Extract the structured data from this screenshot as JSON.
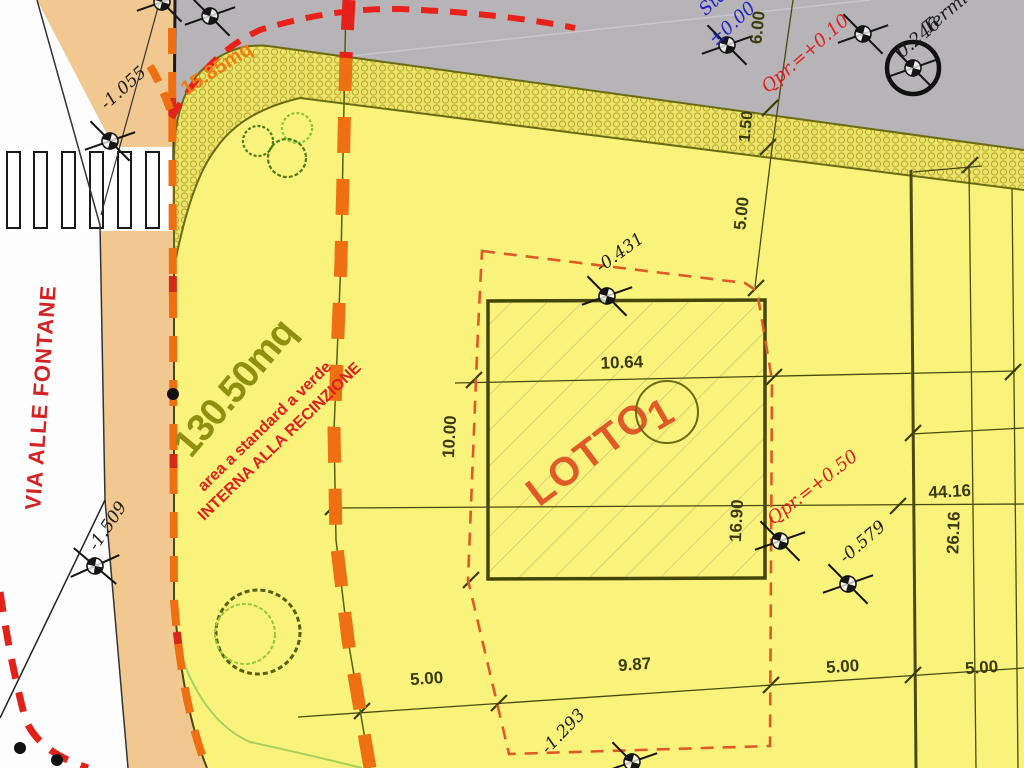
{
  "street": {
    "name": "VIA ALLE FONTANE"
  },
  "areas": {
    "verge": "15.85mq",
    "green": "130.50mq",
    "green_note_1": "area a standard a verde",
    "green_note_2": "INTERNA ALLA RECINZIONE"
  },
  "lot": {
    "label": "LOTTO",
    "number": "1"
  },
  "levels": {
    "road_label": "Std",
    "road_level": "±0.00",
    "qpr_road": "Qpr.=+0.10",
    "qpr_lot": "Qpr.=+0.50",
    "terminal_label": "Termin",
    "terminal_value": "0.246",
    "spot_1": "-1.055",
    "spot_2": "-0.431",
    "spot_3": "-0.579",
    "spot_4": "-1.509",
    "spot_5": "-1.293"
  },
  "dims": {
    "road_width": "6.00",
    "verge_width": "1.50",
    "setback_top": "5.00",
    "lot_width": "10.64",
    "bldg_side": "10.00",
    "lot_height": "16.90",
    "row_total": "44.16",
    "row_inner": "26.16",
    "bottom_1": "5.00",
    "bottom_2": "9.87",
    "bottom_3": "5.00",
    "bottom_4": "5.00"
  },
  "colors": {
    "road_gray": "#b6b4b7",
    "sidewalk_tan": "#f2c891",
    "lot_yellow": "#faf37b",
    "verge_band": "#eae46a",
    "fence_orange": "#ee7012",
    "boundary_red_dash": "#e05a28",
    "alignment_red": "#e8221a",
    "line_olive": "#4a4a10",
    "tree_green_dark": "#4e7a1e",
    "tree_green_light": "#8cc63f"
  }
}
